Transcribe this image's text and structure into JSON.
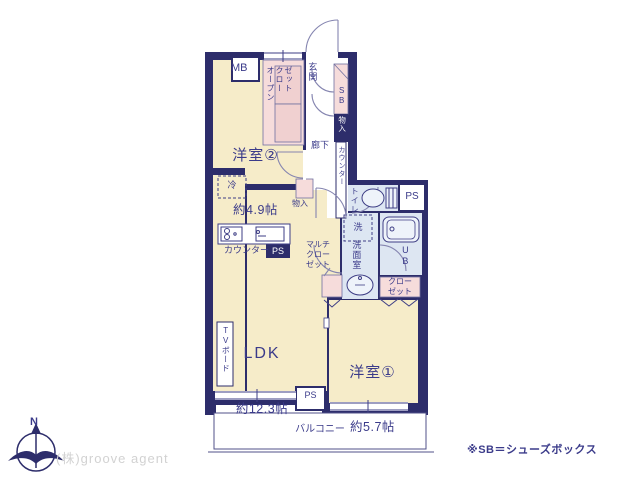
{
  "rooms": {
    "yoshitsu2": {
      "name": "洋室②",
      "size": "約4.9帖"
    },
    "ldk": {
      "name": "LDK",
      "size": "約12.3帖"
    },
    "yoshitsu1": {
      "name": "洋室①",
      "size": "約5.7帖"
    },
    "balcony": {
      "name": "バルコニー"
    },
    "genkan": {
      "name": "玄関"
    },
    "rouka": {
      "name": "廊下"
    },
    "toilet": {
      "name": "トイレ"
    },
    "senmenshitsu": {
      "name": "洗面室"
    }
  },
  "features": {
    "mb": "MB",
    "sb": "SB",
    "ub": "UB",
    "ps_upper": "PS",
    "ps_kitchen": "PS",
    "ps_lower": "PS",
    "open_closet": "オープン\nクロー\nゼット",
    "multi_closet": "マルチ\nクロー\nゼット",
    "closet": "クロー\nゼット",
    "monoire_hall": "物入",
    "monoire_kitchen": "物入",
    "counter_hall": "カウンター",
    "counter_kitchen": "カウンター",
    "rei": "冷",
    "sen": "洗",
    "tv_board": "TVボード"
  },
  "compass": {
    "north": "N"
  },
  "footer": {
    "company": "(株)groove agent",
    "note": "※SB＝シューズボックス"
  },
  "colors": {
    "wall": "#2d2d6b",
    "room_cream": "#f6ecc9",
    "closet_pink": "#f6dcdb",
    "wet_blue": "#dde6f2",
    "text_navy": "#3b3b8a",
    "company_gray": "#d2d2d2"
  }
}
